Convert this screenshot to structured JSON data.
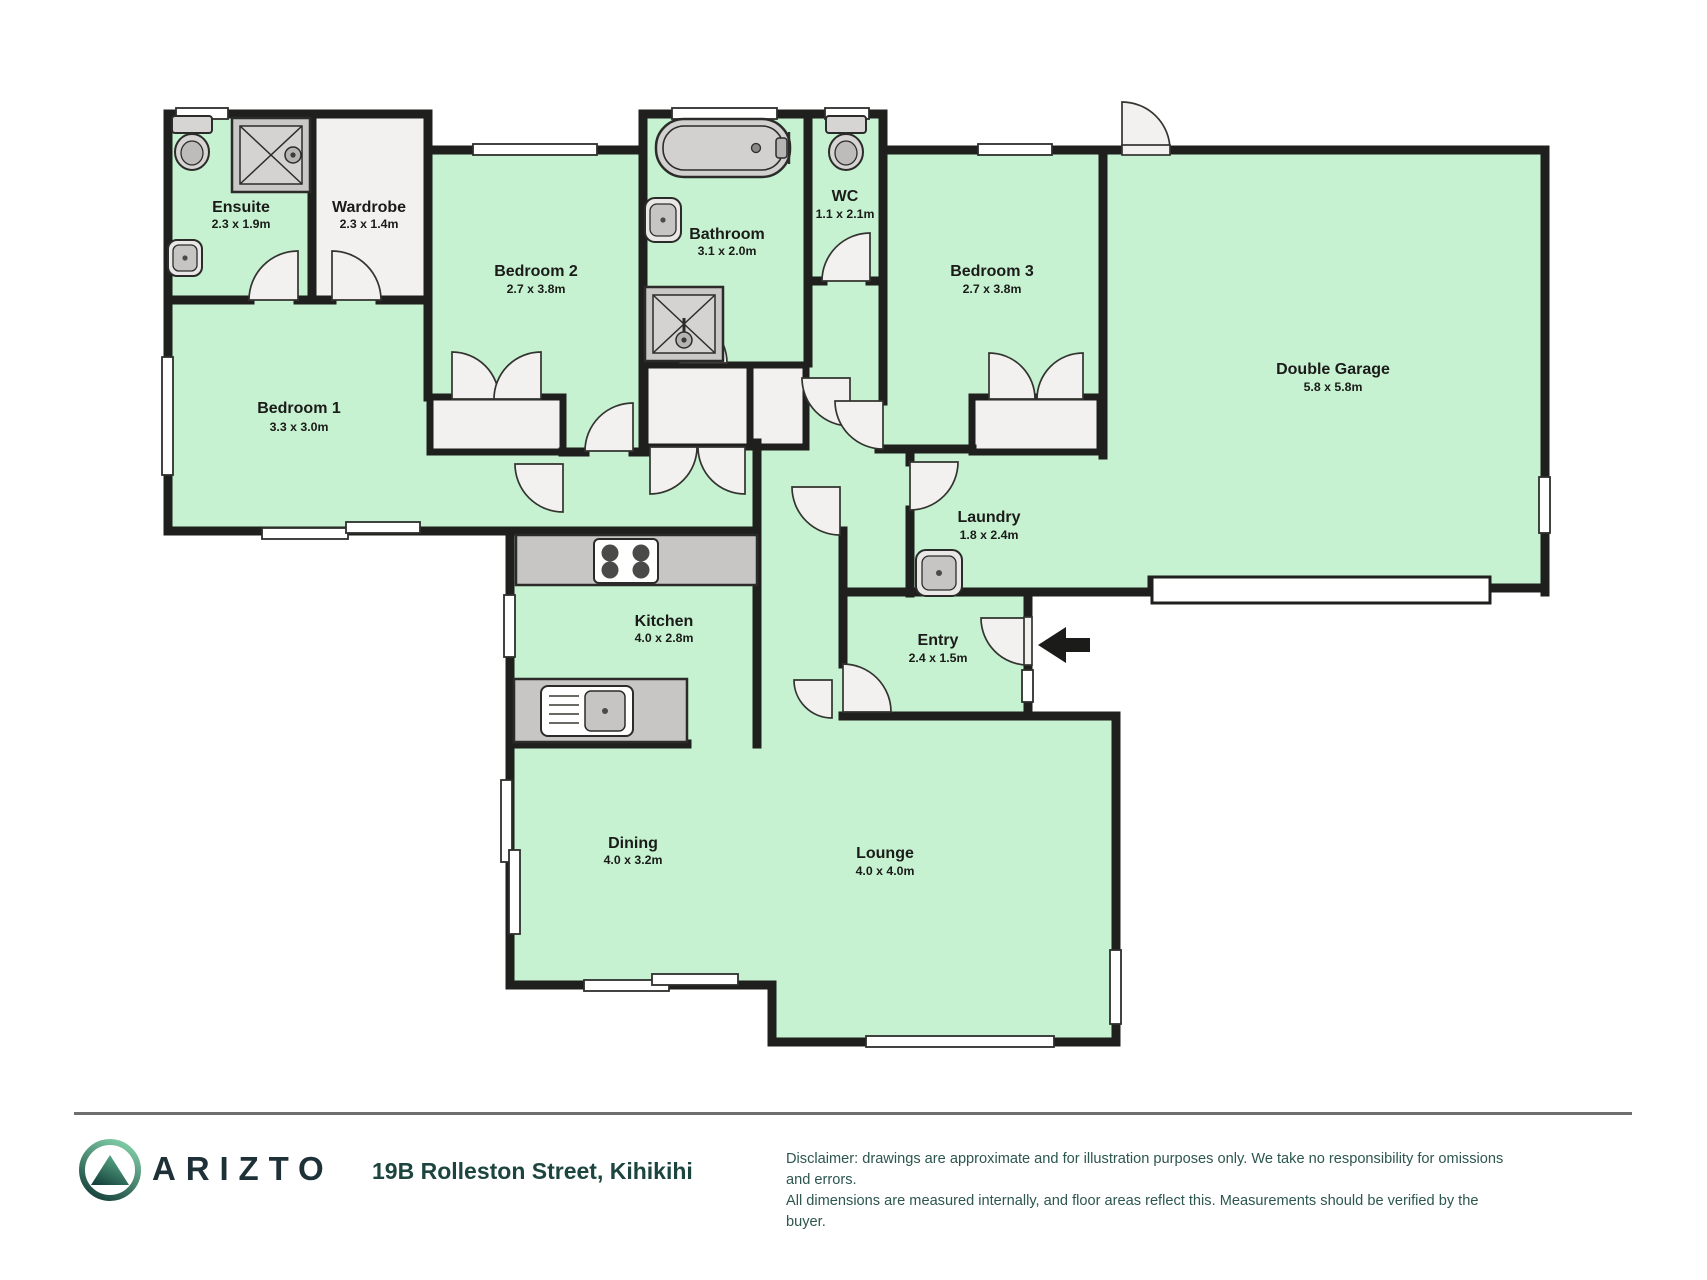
{
  "colors": {
    "floor_green": "#c6f2d1",
    "wall": "#1f1f1d",
    "white_room": "#f2f1ef",
    "fixture_gray": "#c9c8c6",
    "brand_dark": "#1e3138",
    "address_teal": "#1d453f",
    "disclaimer_teal": "#2c564e"
  },
  "floorplan": {
    "rooms": [
      {
        "name": "Ensuite",
        "dims": "2.3 x 1.9m"
      },
      {
        "name": "Wardrobe",
        "dims": "2.3 x 1.4m"
      },
      {
        "name": "Bedroom 2",
        "dims": "2.7 x 3.8m"
      },
      {
        "name": "Bathroom",
        "dims": "3.1 x 2.0m"
      },
      {
        "name": "WC",
        "dims": "1.1 x 2.1m"
      },
      {
        "name": "Bedroom 3",
        "dims": "2.7 x 3.8m"
      },
      {
        "name": "Double Garage",
        "dims": "5.8 x 5.8m"
      },
      {
        "name": "Bedroom 1",
        "dims": "3.3 x 3.0m"
      },
      {
        "name": "Laundry",
        "dims": "1.8 x 2.4m"
      },
      {
        "name": "Kitchen",
        "dims": "4.0 x 2.8m"
      },
      {
        "name": "Entry",
        "dims": "2.4 x 1.5m"
      },
      {
        "name": "Dining",
        "dims": "4.0 x 3.2m"
      },
      {
        "name": "Lounge",
        "dims": "4.0 x 4.0m"
      }
    ]
  },
  "footer": {
    "brand": "ARIZTO",
    "address": "19B Rolleston Street, Kihikihi",
    "disclaimer_line1": "Disclaimer: drawings are approximate and for illustration purposes only. We take no responsibility for omissions and errors.",
    "disclaimer_line2": "All dimensions are measured internally, and floor areas reflect this. Measurements should be verified by the buyer."
  }
}
